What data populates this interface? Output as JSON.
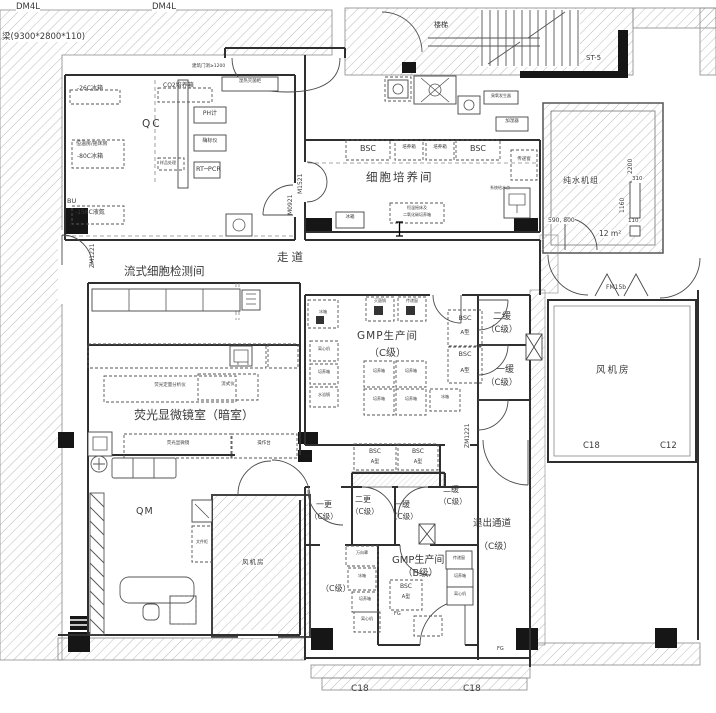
{
  "colors": {
    "line": "#2f2f2f",
    "hatch": "#a8a8a8",
    "black_fill": "#161616",
    "text": "#3a3a3a",
    "background": "#ffffff"
  },
  "labels": [
    {
      "n": "dim-dm4l-1",
      "t": "DM4L",
      "x": 16,
      "y": 3,
      "fs": 8.5,
      "bg": 1
    },
    {
      "n": "dim-dm4l-2",
      "t": "DM4L",
      "x": 152,
      "y": 3,
      "fs": 8.5,
      "bg": 1
    },
    {
      "n": "beam-dimension",
      "t": "梁(9300*2800*110)",
      "x": 2,
      "y": 33,
      "fs": 8.5,
      "bg": 1
    },
    {
      "n": "stair-label",
      "t": "楼梯",
      "x": 434,
      "y": 22,
      "fs": 7
    },
    {
      "n": "stair-code",
      "t": "ST-5",
      "x": 586,
      "y": 55,
      "fs": 7,
      "bg": 1
    },
    {
      "n": "entry-note",
      "t": "建筑门洞≥1200",
      "x": 192,
      "y": 65,
      "fs": 4.5
    },
    {
      "n": "room-qc",
      "t": "QC",
      "x": 142,
      "y": 119,
      "fs": 10.5,
      "ls": 2
    },
    {
      "n": "equip-freezer-26",
      "t": "-26C冰箱",
      "x": 77,
      "y": 86,
      "fs": 6
    },
    {
      "n": "equip-co2-incubator",
      "t": "CO2培养箱",
      "x": 163,
      "y": 83,
      "fs": 6
    },
    {
      "n": "equip-autoclave",
      "t": "湿热灭菌柜",
      "x": 222,
      "y": 80,
      "fs": 4.5,
      "w": 56
    },
    {
      "n": "equip-ph-meter",
      "t": "PH计",
      "x": 194,
      "y": 111,
      "fs": 6,
      "w": 32
    },
    {
      "n": "equip-plate-reader",
      "t": "酶标仪",
      "x": 194,
      "y": 139,
      "fs": 5,
      "w": 32
    },
    {
      "n": "equip-shaker-room",
      "t": "恒温房/摇床房",
      "x": 76,
      "y": 142,
      "fs": 5
    },
    {
      "n": "equip-freezer-80",
      "t": "-80C冰箱",
      "x": 77,
      "y": 154,
      "fs": 6
    },
    {
      "n": "equip-sample-bench",
      "t": "样品处理",
      "x": 160,
      "y": 161,
      "fs": 4
    },
    {
      "n": "equip-rt-pcr",
      "t": "RT─PCR",
      "x": 196,
      "y": 166,
      "fs": 6.5
    },
    {
      "n": "equip-ln2-tank",
      "t": "-156C液氮",
      "x": 75,
      "y": 210,
      "fs": 6
    },
    {
      "n": "mark-bu",
      "t": "BU",
      "x": 67,
      "y": 198,
      "fs": 6.5
    },
    {
      "n": "door-m0921",
      "t": "M0921",
      "x": 288,
      "y": 215,
      "fs": 6,
      "rot": -90
    },
    {
      "n": "door-zm1221-left",
      "t": "ZM1221",
      "x": 90,
      "y": 268,
      "fs": 6,
      "rot": -90
    },
    {
      "n": "room-cell-culture",
      "t": "细胞培养间",
      "x": 366,
      "y": 171,
      "fs": 11.5,
      "ls": 2
    },
    {
      "n": "equip-bsc-1",
      "t": "BSC",
      "x": 346,
      "y": 145,
      "fs": 8,
      "w": 44
    },
    {
      "n": "equip-incubator-1",
      "t": "培养箱",
      "x": 395,
      "y": 146,
      "fs": 4.5,
      "w": 28
    },
    {
      "n": "equip-incubator-2",
      "t": "培养箱",
      "x": 426,
      "y": 146,
      "fs": 4.5,
      "w": 28
    },
    {
      "n": "equip-bsc-2",
      "t": "BSC",
      "x": 456,
      "y": 145,
      "fs": 8,
      "w": 44
    },
    {
      "n": "door-m1521",
      "t": "M1521",
      "x": 298,
      "y": 194,
      "fs": 6,
      "rot": -90
    },
    {
      "n": "note-shaker-1",
      "t": "恒温摇床及",
      "x": 392,
      "y": 206,
      "fs": 4,
      "w": 50
    },
    {
      "n": "note-shaker-2",
      "t": "二氧化碳培养箱",
      "x": 390,
      "y": 213,
      "fs": 4,
      "w": 54
    },
    {
      "n": "equip-fridge-cc",
      "t": "冰箱",
      "x": 336,
      "y": 216,
      "fs": 4.5,
      "w": 28
    },
    {
      "n": "equip-pass-window-cc",
      "t": "传递窗",
      "x": 511,
      "y": 158,
      "fs": 4.5,
      "w": 26
    },
    {
      "n": "note-water-point",
      "t": "系统给水点",
      "x": 490,
      "y": 186,
      "fs": 4
    },
    {
      "n": "equip-humidifier",
      "t": "加湿器",
      "x": 496,
      "y": 120,
      "fs": 4.5,
      "w": 32
    },
    {
      "n": "equip-ozone",
      "t": "臭氧发生器",
      "x": 484,
      "y": 94,
      "fs": 4,
      "w": 34
    },
    {
      "n": "corridor-label",
      "t": "走道",
      "x": 277,
      "y": 251,
      "fs": 11.5,
      "ls": 3
    },
    {
      "n": "room-flow-cytometry",
      "t": "流式细胞检测间",
      "x": 124,
      "y": 265,
      "fs": 11.5
    },
    {
      "n": "room-fluorescence",
      "t": "荧光显微镜室（暗室）",
      "x": 134,
      "y": 409,
      "fs": 12
    },
    {
      "n": "equip-fluor-analyzer",
      "t": "荧光定量分析仪",
      "x": 104,
      "y": 384,
      "fs": 4.5,
      "w": 132
    },
    {
      "n": "equip-flow-cytometer",
      "t": "流式仪",
      "x": 198,
      "y": 383,
      "fs": 4.5,
      "w": 60
    },
    {
      "n": "equip-fluor-microscope",
      "t": "荧光显微镜",
      "x": 124,
      "y": 442,
      "fs": 4.5,
      "w": 108
    },
    {
      "n": "equip-worktable",
      "t": "操作台",
      "x": 231,
      "y": 442,
      "fs": 4.5,
      "w": 66
    },
    {
      "n": "room-qm",
      "t": "QM",
      "x": 136,
      "y": 507,
      "fs": 9.5,
      "ls": 1
    },
    {
      "n": "equip-cabinet",
      "t": "文件柜",
      "x": 193,
      "y": 540,
      "fs": 4,
      "w": 18
    },
    {
      "n": "room-fan-2",
      "t": "风机房",
      "x": 242,
      "y": 559,
      "fs": 6.5,
      "ls": 1,
      "bg": 1
    },
    {
      "n": "room-gmp-c-1",
      "t": "GMP生产间",
      "x": 357,
      "y": 331,
      "fs": 10.5,
      "ls": 1
    },
    {
      "n": "room-gmp-c-2",
      "t": "（C级）",
      "x": 369,
      "y": 349,
      "fs": 10
    },
    {
      "n": "equip-bsc-c1",
      "t": "BSC",
      "x": 448,
      "y": 315,
      "fs": 6.5,
      "w": 34
    },
    {
      "n": "equip-bsc-c1-type",
      "t": "A型",
      "x": 448,
      "y": 331,
      "fs": 5.5,
      "w": 34
    },
    {
      "n": "equip-bsc-c2",
      "t": "BSC",
      "x": 448,
      "y": 351,
      "fs": 6.5,
      "w": 34
    },
    {
      "n": "equip-bsc-c2-type",
      "t": "A型",
      "x": 448,
      "y": 369,
      "fs": 5.5,
      "w": 34
    },
    {
      "n": "door-zm1221-right",
      "t": "ZM1221",
      "x": 465,
      "y": 448,
      "fs": 6,
      "rot": -90
    },
    {
      "n": "room-buffer2-c",
      "t": "二缓",
      "x": 493,
      "y": 313,
      "fs": 9
    },
    {
      "n": "room-buffer2-c-grade",
      "t": "（C级）",
      "x": 486,
      "y": 326,
      "fs": 8.5
    },
    {
      "n": "room-buffer1-c",
      "t": "一缓",
      "x": 496,
      "y": 366,
      "fs": 9
    },
    {
      "n": "room-buffer1-c-grade",
      "t": "（C级）",
      "x": 486,
      "y": 379,
      "fs": 8.5
    },
    {
      "n": "room-fan-right",
      "t": "风机房",
      "x": 596,
      "y": 366,
      "fs": 9.5,
      "ls": 2
    },
    {
      "n": "mark-c18-right",
      "t": "C18",
      "x": 583,
      "y": 442,
      "fs": 8.5
    },
    {
      "n": "mark-c12",
      "t": "C12",
      "x": 660,
      "y": 442,
      "fs": 8.5
    },
    {
      "n": "door-fm15b",
      "t": "FM15b",
      "x": 606,
      "y": 285,
      "fs": 6
    },
    {
      "n": "room-pure-water",
      "t": "纯水机组",
      "x": 563,
      "y": 177,
      "fs": 8,
      "ls": 1,
      "bg": 1
    },
    {
      "n": "dim-2200",
      "t": "2200",
      "x": 628,
      "y": 174,
      "fs": 6,
      "rot": -90,
      "bg": 1
    },
    {
      "n": "dim-310",
      "t": "310",
      "x": 632,
      "y": 177,
      "fs": 5.5,
      "bg": 1
    },
    {
      "n": "dim-1160",
      "t": "1160",
      "x": 620,
      "y": 213,
      "fs": 6,
      "rot": -90,
      "bg": 1
    },
    {
      "n": "dim-110",
      "t": "110",
      "x": 628,
      "y": 219,
      "fs": 5.5,
      "bg": 1
    },
    {
      "n": "dim-590-800",
      "t": "590, 800",
      "x": 548,
      "y": 218,
      "fs": 6,
      "bg": 1
    },
    {
      "n": "dim-area-12",
      "t": "12 m²",
      "x": 599,
      "y": 230,
      "fs": 7.5,
      "bg": 1
    },
    {
      "n": "equip-bsc-b1",
      "t": "BSC",
      "x": 354,
      "y": 449,
      "fs": 6,
      "w": 42
    },
    {
      "n": "equip-bsc-b1-type",
      "t": "A型",
      "x": 354,
      "y": 460,
      "fs": 5,
      "w": 42
    },
    {
      "n": "equip-bsc-b2",
      "t": "BSC",
      "x": 398,
      "y": 449,
      "fs": 6,
      "w": 40
    },
    {
      "n": "equip-bsc-b2-type",
      "t": "A型",
      "x": 398,
      "y": 460,
      "fs": 5,
      "w": 40
    },
    {
      "n": "room-change1",
      "t": "一更",
      "x": 316,
      "y": 501,
      "fs": 8
    },
    {
      "n": "room-change1-grade",
      "t": "（C级）",
      "x": 310,
      "y": 513,
      "fs": 7.5
    },
    {
      "n": "room-change2",
      "t": "二更",
      "x": 355,
      "y": 496,
      "fs": 8
    },
    {
      "n": "room-change2-grade",
      "t": "（C级）",
      "x": 351,
      "y": 508,
      "fs": 7.5
    },
    {
      "n": "room-buffer1-b",
      "t": "一缓",
      "x": 394,
      "y": 501,
      "fs": 8
    },
    {
      "n": "room-buffer1-b-grade",
      "t": "（C级）",
      "x": 390,
      "y": 513,
      "fs": 7.5
    },
    {
      "n": "room-buffer2-b",
      "t": "二缓",
      "x": 443,
      "y": 486,
      "fs": 8
    },
    {
      "n": "room-buffer2-b-grade",
      "t": "（C级）",
      "x": 439,
      "y": 498,
      "fs": 7.5
    },
    {
      "n": "room-exit-corridor",
      "t": "退出通道",
      "x": 473,
      "y": 519,
      "fs": 9.5
    },
    {
      "n": "room-exit-corridor-grade",
      "t": "（C级）",
      "x": 479,
      "y": 543,
      "fs": 9
    },
    {
      "n": "room-gmp-b-1",
      "t": "GMP生产间",
      "x": 392,
      "y": 556,
      "fs": 10
    },
    {
      "n": "room-gmp-b-2",
      "t": "（B级）",
      "x": 403,
      "y": 569,
      "fs": 9.5
    },
    {
      "n": "equip-bsc-b3",
      "t": "BSC",
      "x": 390,
      "y": 584,
      "fs": 6,
      "w": 32
    },
    {
      "n": "equip-bsc-b3-type",
      "t": "A型",
      "x": 390,
      "y": 595,
      "fs": 5,
      "w": 32
    },
    {
      "n": "room-c-grade-left",
      "t": "（C级）",
      "x": 321,
      "y": 585,
      "fs": 8
    },
    {
      "n": "equip-b-left-1",
      "t": "万向罩",
      "x": 346,
      "y": 551,
      "fs": 4,
      "w": 32
    },
    {
      "n": "equip-b-left-2",
      "t": "冰箱",
      "x": 348,
      "y": 574,
      "fs": 4,
      "w": 28
    },
    {
      "n": "equip-b-left-3",
      "t": "培养箱",
      "x": 352,
      "y": 597,
      "fs": 4,
      "w": 26
    },
    {
      "n": "equip-b-left-4",
      "t": "离心机",
      "x": 354,
      "y": 617,
      "fs": 4,
      "w": 26
    },
    {
      "n": "equip-b-right-1",
      "t": "传递窗",
      "x": 446,
      "y": 556,
      "fs": 4,
      "w": 26
    },
    {
      "n": "equip-b-right-2",
      "t": "培养箱",
      "x": 447,
      "y": 574,
      "fs": 4,
      "w": 26
    },
    {
      "n": "equip-b-right-3",
      "t": "离心机",
      "x": 447,
      "y": 592,
      "fs": 4,
      "w": 26
    },
    {
      "n": "mark-fg-1",
      "t": "FG",
      "x": 394,
      "y": 612,
      "fs": 5
    },
    {
      "n": "mark-fg-2",
      "t": "FG",
      "x": 497,
      "y": 647,
      "fs": 5
    },
    {
      "n": "mark-c18-bottom-1",
      "t": "C18",
      "x": 351,
      "y": 685,
      "fs": 9
    },
    {
      "n": "mark-c18-bottom-2",
      "t": "C18",
      "x": 463,
      "y": 685,
      "fs": 9
    },
    {
      "n": "equip-c-left-1",
      "t": "冰箱",
      "x": 308,
      "y": 310,
      "fs": 4,
      "w": 30
    },
    {
      "n": "equip-c-left-2",
      "t": "离心机",
      "x": 310,
      "y": 347,
      "fs": 4,
      "w": 28
    },
    {
      "n": "equip-c-left-3",
      "t": "培养箱",
      "x": 310,
      "y": 370,
      "fs": 4,
      "w": 28
    },
    {
      "n": "equip-c-left-4",
      "t": "水浴锅",
      "x": 310,
      "y": 393,
      "fs": 4,
      "w": 28
    },
    {
      "n": "equip-c-center-1",
      "t": "培养箱",
      "x": 364,
      "y": 369,
      "fs": 4,
      "w": 30
    },
    {
      "n": "equip-c-center-2",
      "t": "培养箱",
      "x": 396,
      "y": 369,
      "fs": 4,
      "w": 30
    },
    {
      "n": "equip-c-center-3",
      "t": "培养箱",
      "x": 364,
      "y": 397,
      "fs": 4,
      "w": 30
    },
    {
      "n": "equip-c-center-4",
      "t": "培养箱",
      "x": 396,
      "y": 397,
      "fs": 4,
      "w": 30
    },
    {
      "n": "equip-c-center-5",
      "t": "冰箱",
      "x": 430,
      "y": 395,
      "fs": 4,
      "w": 30
    },
    {
      "n": "equip-c-top-1",
      "t": "灭菌锅",
      "x": 366,
      "y": 299,
      "fs": 4,
      "w": 28
    },
    {
      "n": "equip-c-top-2",
      "t": "传递窗",
      "x": 398,
      "y": 299,
      "fs": 4,
      "w": 28
    }
  ]
}
